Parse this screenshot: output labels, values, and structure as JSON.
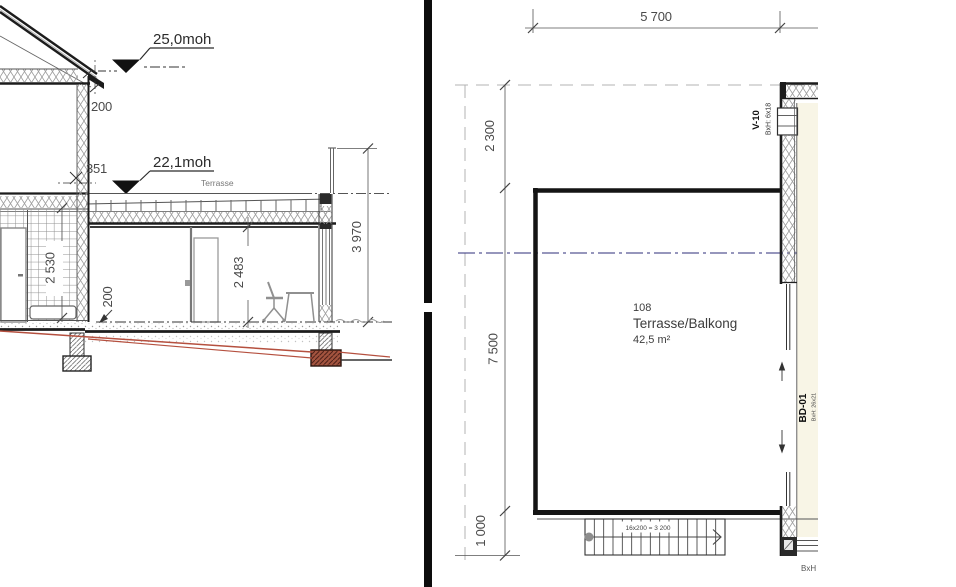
{
  "section": {
    "elev_upper": "25,0moh",
    "elev_lower": "22,1moh",
    "terrace_label": "Terrasse",
    "dim_roof_edge": "200",
    "dim_parapet": "351",
    "dim_bath_height": "2 530",
    "dim_floor_thickness": "200",
    "dim_room_height": "2 483",
    "dim_total_height": "3 970"
  },
  "plan": {
    "dim_width_top": "5 700",
    "dim_left_upper": "2 300",
    "dim_left_main": "7 500",
    "dim_left_lower": "1 000",
    "room_number": "108",
    "room_name": "Terrasse/Balkong",
    "room_area": "42,5 m²",
    "window_tag": "V-10",
    "window_size": "BxH: 6x18",
    "door_tag": "BD-01",
    "door_size": "BxH: 26x21",
    "stair_note": "16x200 = 3 200",
    "edge_note": "BxH"
  },
  "colors": {
    "line_dark": "#1c1c1c",
    "dim_gray": "#4a4a4a",
    "terrain_red": "#b5503f",
    "centerline_navy": "#2e2e7a",
    "interior_floor_cream": "#f8f5e6",
    "footing_brown": "#a3543f"
  }
}
